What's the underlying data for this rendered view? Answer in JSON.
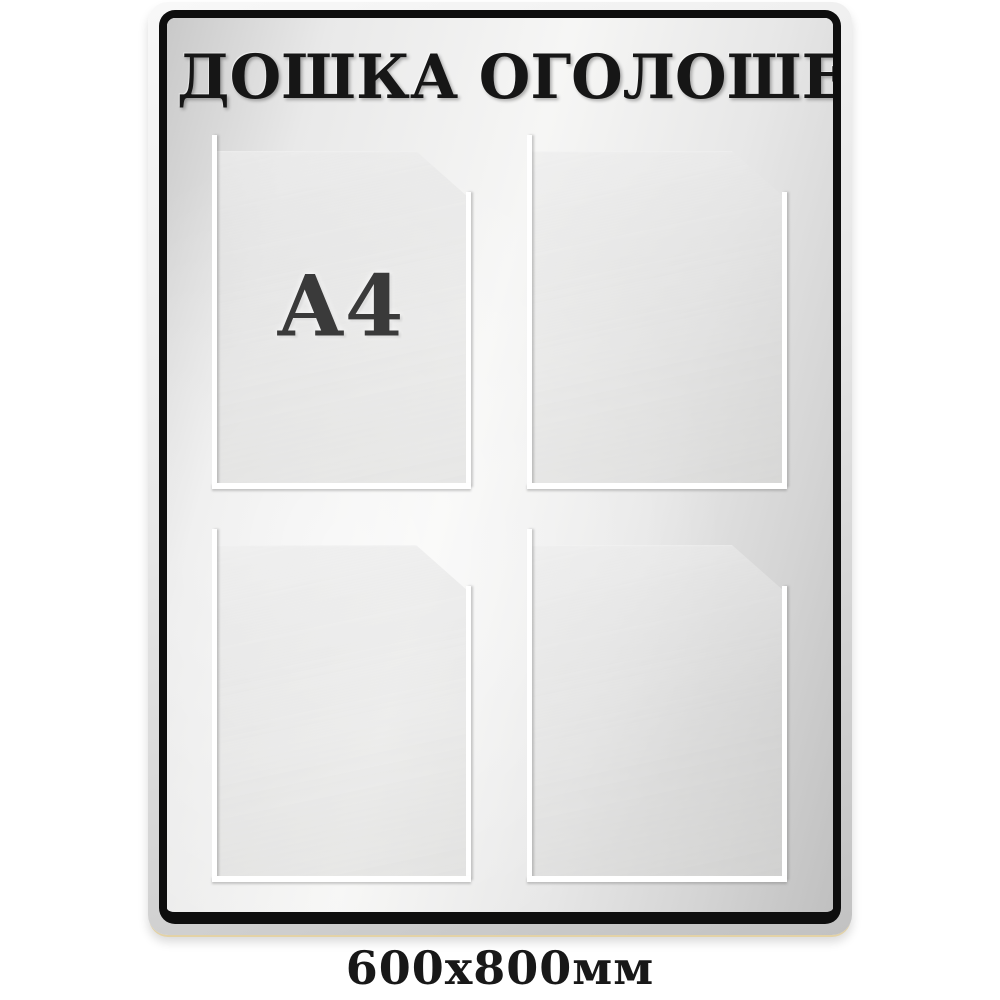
{
  "board": {
    "title": "ДОШКА ОГОЛОШЕНЬ",
    "pocket_label": "A4",
    "size_label": "600x800мм",
    "pocket_count": 4,
    "pocket_format": "A4",
    "colors": {
      "frame_black": "#0e0e0e",
      "board_silver_light": "#f6f6f5",
      "board_silver_dark": "#c0c0c0",
      "pocket_edge_white": "#ffffff",
      "title_text": "#161616",
      "label_text": "#3a3a3a",
      "background": "#ffffff"
    }
  }
}
